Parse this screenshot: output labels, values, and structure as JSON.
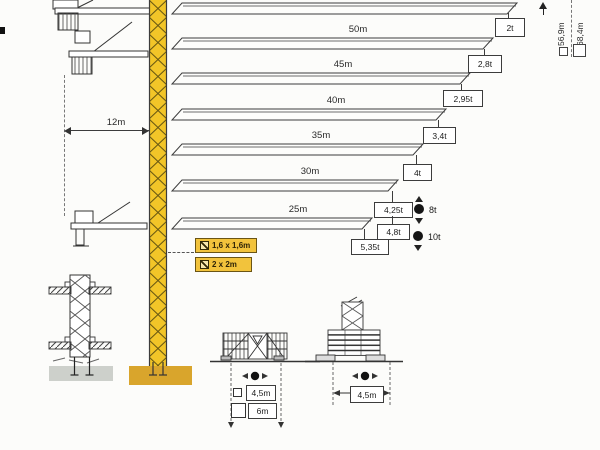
{
  "diagram_type": "tower-crane load and configuration diagram",
  "colors": {
    "mast_yellow": "#f2c528",
    "mast_foundation_ochre": "#d9a52c",
    "tag_yellow": "#f2c33c",
    "foundation_gray": "#cdd0cb",
    "line": "#3c3c3c"
  },
  "crane": {
    "counter_radius_label": "12m",
    "tower_tags": [
      {
        "icon": "checked-box-icon",
        "label": "1,6 x 1,6m"
      },
      {
        "icon": "checked-box-icon",
        "label": "2 x 2m"
      }
    ],
    "hook_heights": [
      {
        "label": "56,9m",
        "marker": "small-square-icon"
      },
      {
        "label": "68,4m",
        "marker": "large-square-icon"
      }
    ]
  },
  "load_chart": {
    "jibs": [
      {
        "length_label": "",
        "tip_load": "2t"
      },
      {
        "length_label": "50m",
        "tip_load": "2,8t"
      },
      {
        "length_label": "45m",
        "tip_load": "2,95t"
      },
      {
        "length_label": "40m",
        "tip_load": "3,4t"
      },
      {
        "length_label": "35m",
        "tip_load": "4t"
      },
      {
        "length_label": "30m",
        "tip_load": "4,25t",
        "tip_load_2": "4,8t"
      },
      {
        "length_label": "25m",
        "tip_load": "5,35t"
      }
    ],
    "max_loads": [
      {
        "label": "8t",
        "marker": "black-dot-icon"
      },
      {
        "label": "10t",
        "marker": "black-dot-icon"
      }
    ]
  },
  "bases": {
    "cross_base": {
      "width_a": "4,5m",
      "width_b": "6m"
    },
    "central_ballast_base": {
      "width": "4,5m"
    }
  }
}
